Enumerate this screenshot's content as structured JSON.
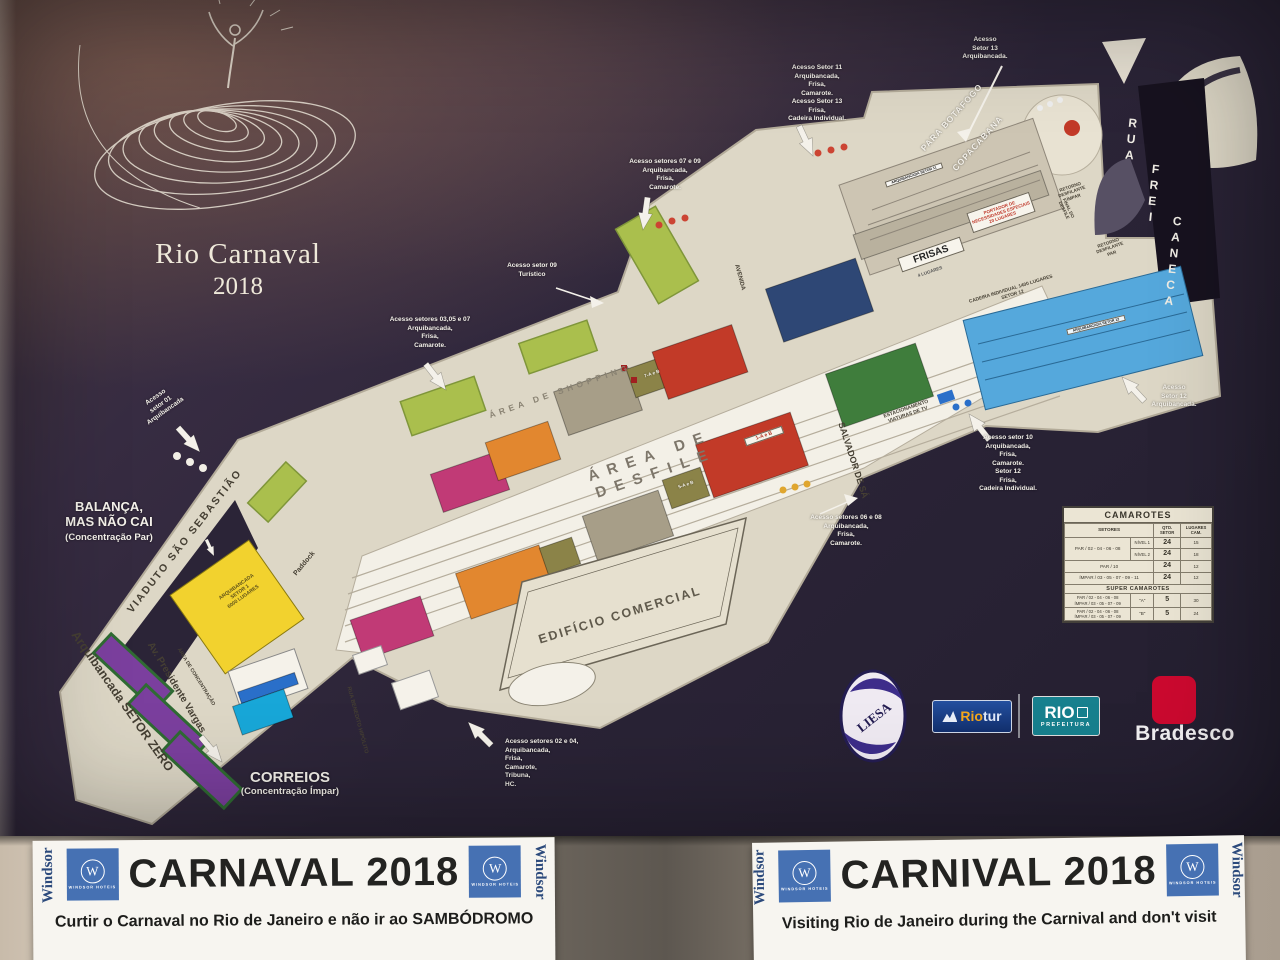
{
  "poster": {
    "title": {
      "line1": "Rio Carnaval",
      "line2": "2018"
    },
    "annotations": {
      "setor13": "Acesso\nSetor 13\nArquibancada.",
      "setor11": "Acesso Setor 11\nArquibancada,\nFrisa,\nCamarote.\nAcesso Setor 13\nFrisa,\nCadeira Individual.",
      "setores_07_09": "Acesso setores 07 e 09\nArquibancada,\nFrisa,\nCamarote.",
      "setor_09": "Acesso setor 09\nTurístico",
      "setores_03_05_07": "Acesso setores 03,05 e 07\nArquibancada,\nFrisa,\nCamarote.",
      "setor_01": "Acesso\nsetor 01\nArquibancada",
      "balanca_main": "BALANÇA,\nMAS NÃO CAI",
      "balanca_sub": "(Concentração Par)",
      "correios_main": "CORREIOS",
      "correios_sub": "(Concentração Ímpar)",
      "setores_02_04": "Acesso setores 02 e 04,\nArquibancada,\nFrisa,\nCamarote,\nTribuna,\nHC.",
      "setores_06_08": "Acesso setores 06 e 08\nArquibancada,\nFrisa,\nCamarote.",
      "setor_10": "Acesso setor 10\nArquibancada,\nFrisa,\nCamarote.\nSetor 12\nFrisa,\nCadeira Individual.",
      "setor_12": "Acesso\nSetor 12\nArquibancada."
    },
    "streets": {
      "viaduto": "VIADUTO  SÃO  SEBASTIÃO",
      "vargas": "Av. Presidente Vargas",
      "setor_zero": "Arquibancada SETOR ZERO",
      "salvador": "SALVADOR DE SÁ",
      "avenida": "AVENIDA",
      "benedito": "RUA BENEDITO HIPÓLITO",
      "concentracao": "ÁREA DE CONCENTRAÇÃO",
      "paddock": "Paddock",
      "frei_rua": "RUA",
      "frei_frei": "FREI",
      "frei_caneca": "CANECA",
      "para_botafogo": "PARA BOTAFOGO",
      "copacabana": "COPACABANA",
      "area_shopping": "ÁREA  DE  SHOPPING",
      "area_desfile": "ÁREA  DE  DESFILE"
    },
    "features": {
      "frisas": "FRISAS",
      "frisas_sub": "4 LUGARES",
      "edificio": "EDIFÍCIO COMERCIAL",
      "cadeira_setor12": "CADEIRA INDIVIDUAL 1400 LUGARES\nSETOR 12",
      "pne": "PORTADOR DE\nNECESSIDADES ESPECIAIS\n20 LUGARES",
      "retorno_impar": "RETORNO\nDESFILANTE\nÍMPAR",
      "retorno_par": "RETORNO\nDESFILANTE\nPAR",
      "final_desfile": "FINAL DO\nDESFILE",
      "estacionamento": "ESTACIONAMENTO\nVIATURAS DE TV",
      "setor1": "ARQUIBANCADA\nSETOR 1\n6000 LUGARES",
      "setor11_tag": "ARQUIBANCADA SETOR 11",
      "setor12_tag": "ARQUIBANCADA SETOR 12",
      "block_7ab": "7-A e B",
      "block_5ab": "5-A e B",
      "block_1ab": "1-A e B"
    },
    "camarotes_table": {
      "title": "CAMAROTES",
      "col_setores": "SETORES",
      "col_qtd": "QTD. SETOR",
      "col_lugares": "LUGARES CAM.",
      "row1_setores": "PAR / 02 - 04 - 06 - 08",
      "row1_nivel": "NÍVEL 1",
      "row1_qtd": "24",
      "row1_lugares": "15",
      "row2_nivel": "NÍVEL 2",
      "row2_qtd": "24",
      "row2_lugares": "18",
      "row3_setores": "PAR / 10",
      "row3_qtd": "24",
      "row3_lugares": "12",
      "row4_setores": "ÍMPAR / 03 - 05 - 07 - 09 - 11",
      "row4_qtd": "24",
      "row4_lugares": "12",
      "super_title": "SUPER CAMAROTES",
      "superA_par": "PAR / 02 - 04 - 06 - 08",
      "superA_impar": "ÍMPAR / 03 - 05 - 07 - 09",
      "superA_tipo": "\"A\"",
      "superA_qtd": "5",
      "superA_lugares": "30",
      "superB_par": "PAR / 02 - 04 - 06 - 08",
      "superB_impar": "ÍMPAR / 03 - 05 - 07 - 09",
      "superB_tipo": "\"B\"",
      "superB_qtd": "5",
      "superB_lugares": "24"
    },
    "logos": {
      "liesa": "LIESA",
      "riotur_part1": "Rio",
      "riotur_part2": "tur",
      "rio": "RIO",
      "prefeitura": "PREFEITURA",
      "bradesco": "Bradesco"
    },
    "colors": {
      "accent_yellow": "#f2d22e",
      "accent_blue": "#55a8dc",
      "accent_red": "#c23a28",
      "accent_purple": "#7b3f9e",
      "bradesco_red": "#cc092f",
      "prefeitura_teal": "#17808e",
      "riotur_blue": "#16377f",
      "windsor_blue": "#4671b3"
    }
  },
  "sheets": {
    "left": {
      "title": "CARNAVAL 2018",
      "subtitle": "Curtir o Carnaval no Rio de Janeiro e não ir ao SAMBÓDROMO"
    },
    "right": {
      "title": "CARNIVAL 2018",
      "subtitle": "Visiting Rio de Janeiro during the Carnival and don't visit"
    },
    "windsor": {
      "name": "Windsor",
      "sub": "WINDSOR HOTEIS",
      "monogram": "W"
    }
  }
}
